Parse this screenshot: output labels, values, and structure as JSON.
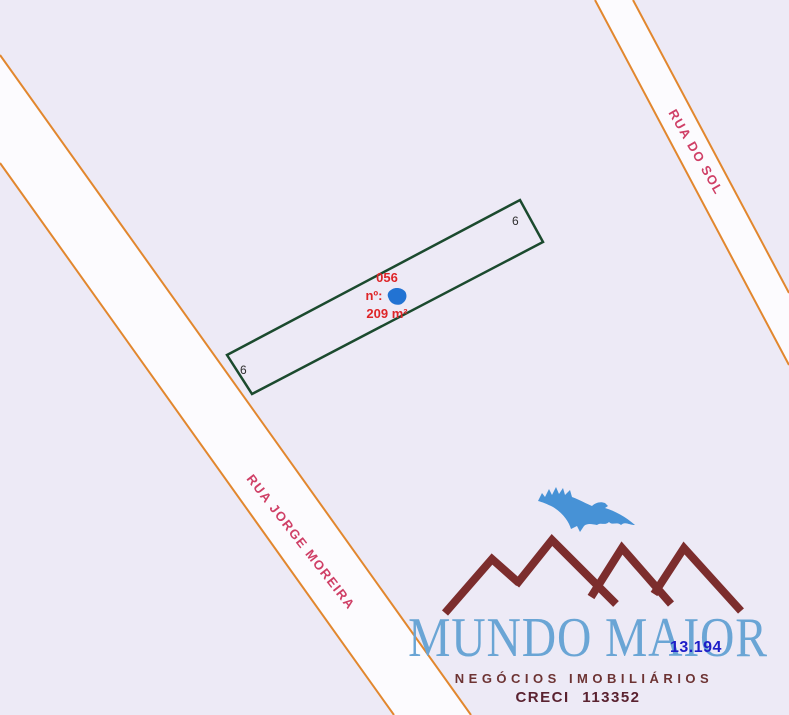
{
  "map": {
    "streets": [
      {
        "name": "RUA DO SOL"
      },
      {
        "name": "RUA JORGE MOREIRA"
      }
    ],
    "lot": {
      "code": "056",
      "number_label": "nº:",
      "area": "209 m²",
      "corner_labels": [
        "6",
        "6"
      ]
    },
    "overlay_number": "13.194"
  },
  "logo": {
    "title": "MUNDO MAIOR",
    "subtitle": "NEGÓCIOS IMOBILIÁRIOS",
    "creci": "CRECI 113352"
  },
  "colors": {
    "background": "#edeaf6",
    "street_fill": "#fcfbfe",
    "street_line": "#e2872e",
    "street_label": "#cf3f66",
    "lot_outline": "#1b4a2e",
    "lot_label_red": "#de2427",
    "lot_marker_blue": "#2273d3",
    "corner_label": "#2e2e2e",
    "overlay_number_blue": "#1d1dc8",
    "logo_title_blue": "#6aa5d5",
    "logo_subtitle_maroon": "#6d3333",
    "logo_creci_maroon": "#5a2230",
    "logo_bird_blue": "#4792d6",
    "logo_mountains_maroon": "#7c2d2d"
  }
}
